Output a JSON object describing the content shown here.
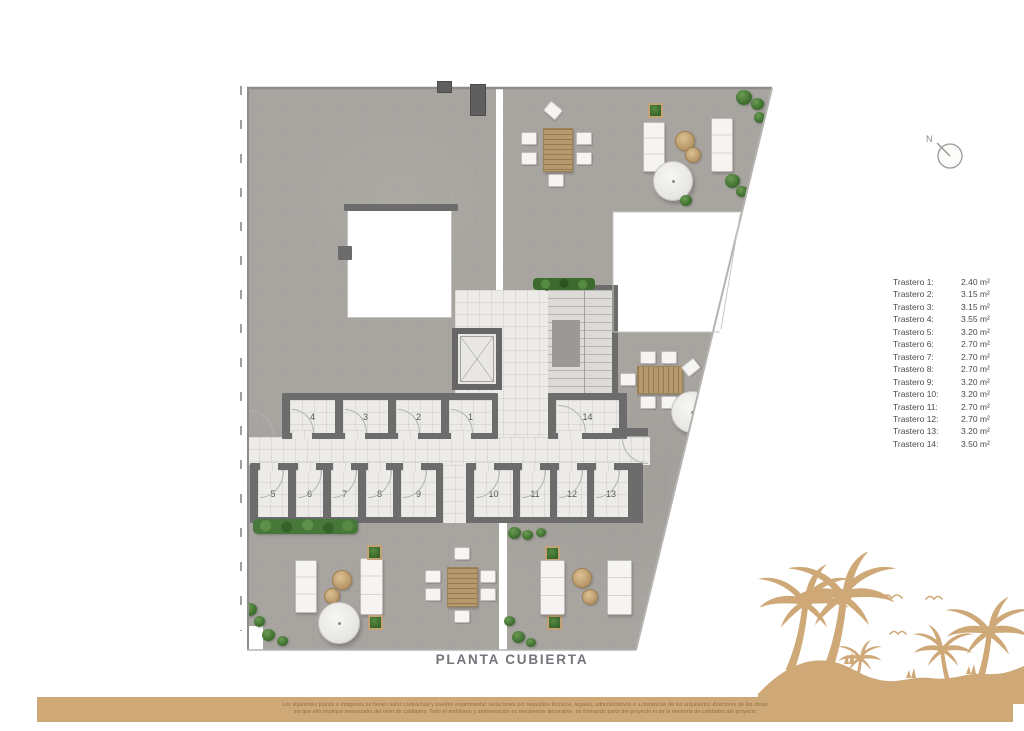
{
  "plan": {
    "title": "PLANTA CUBIERTA",
    "north_label": "N",
    "rooms": {
      "r1": "1",
      "r2": "2",
      "r3": "3",
      "r4": "4",
      "r5": "5",
      "r6": "6",
      "r7": "7",
      "r8": "8",
      "r9": "9",
      "r10": "10",
      "r11": "11",
      "r12": "12",
      "r13": "13",
      "r14": "14"
    }
  },
  "legend": {
    "items": [
      {
        "label": "Trastero 1:",
        "value": "2.40 m²"
      },
      {
        "label": "Trastero 2:",
        "value": "3.15 m²"
      },
      {
        "label": "Trastero 3:",
        "value": "3.15 m²"
      },
      {
        "label": "Trastero 4:",
        "value": "3.55 m²"
      },
      {
        "label": "Trastero 5:",
        "value": "3.20 m²"
      },
      {
        "label": "Trastero 6:",
        "value": "2.70 m²"
      },
      {
        "label": "Trastero 7:",
        "value": "2.70 m²"
      },
      {
        "label": "Trastero 8:",
        "value": "2.70 m²"
      },
      {
        "label": "Trastero 9:",
        "value": "3.20 m²"
      },
      {
        "label": "Trastero 10:",
        "value": "3.20 m²"
      },
      {
        "label": "Trastero 11:",
        "value": "2.70 m²"
      },
      {
        "label": "Trastero 12:",
        "value": "2.70 m²"
      },
      {
        "label": "Trastero 13:",
        "value": "3.20 m²"
      },
      {
        "label": "Trastero 14:",
        "value": "3.50 m²"
      }
    ]
  },
  "footer": {
    "disclaimer_line1": "Los siguientes planos e imágenes no tienen valor contractual y pueden experimentar variaciones por requisitos técnicos, legales, administrativos o a instancias de los arquitectos directores de las obras",
    "disclaimer_line2": "sin que ello implique menoscabo del nivel de calidades. Todo el mobiliario y ambientación es meramente decorativo, no formando parte del proyecto ni de la memoria de calidades del proyecto"
  },
  "colors": {
    "sand": "#cfa877",
    "terrace_tile": "#a8a5a0",
    "wall": "#6c6c6c",
    "interior_floor": "#ecebe8",
    "wood": "#b69a6e",
    "plant_green": "#4c7f3c",
    "legend_text": "#4b4b4b",
    "title_text": "#74747a"
  },
  "icons": {
    "north": "north-compass-icon",
    "palms": "palm-beach-silhouette"
  }
}
